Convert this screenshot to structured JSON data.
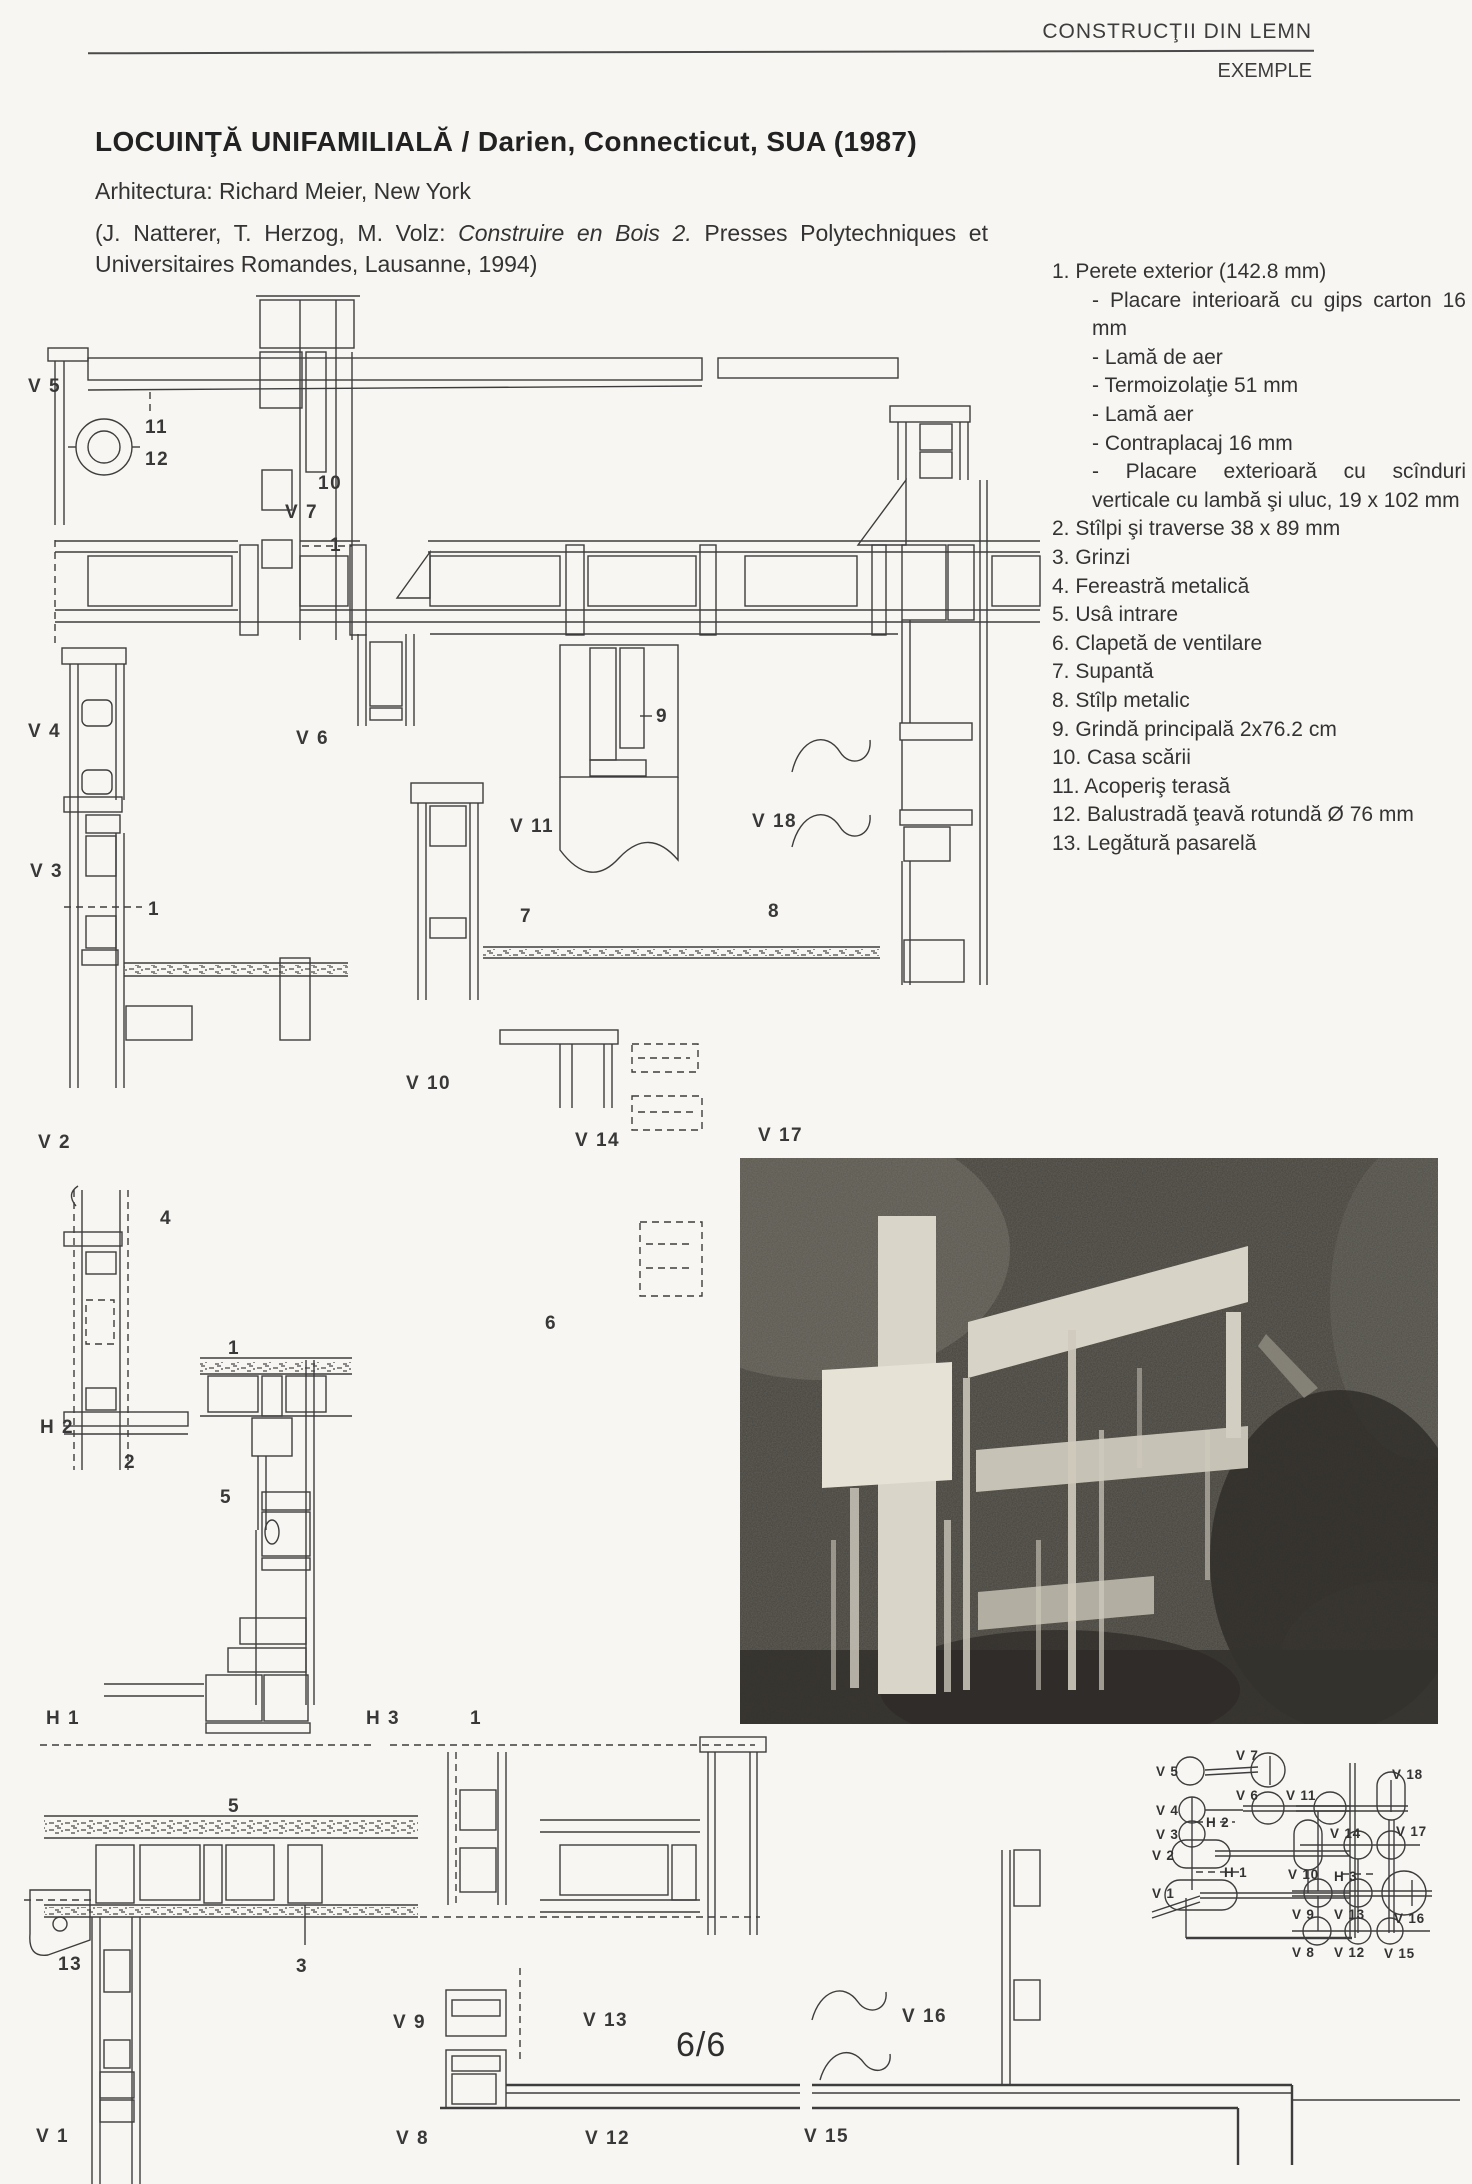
{
  "header": {
    "book_title": "CONSTRUCŢII DIN LEMN",
    "section": "EXEMPLE"
  },
  "title": "LOCUINŢĂ UNIFAMILIALĂ / Darien, Connecticut, SUA (1987)",
  "architect_line": "Arhitectura: Richard Meier, New York",
  "citation": {
    "part1": "(J. Natterer, T. Herzog, M. Volz: ",
    "italic": "Construire en Bois 2.",
    "part2": " Presses Polytechniques et Universitaires Romandes, Lausanne, 1994)"
  },
  "legend": {
    "items": [
      {
        "text": "1. Perete exterior (142.8 mm)",
        "indent": 0
      },
      {
        "text": "- Placare interioară cu gips carton 16 mm",
        "indent": 1
      },
      {
        "text": "- Lamă de aer",
        "indent": 1
      },
      {
        "text": "- Termoizolaţie 51 mm",
        "indent": 1
      },
      {
        "text": "- Lamă aer",
        "indent": 1
      },
      {
        "text": "- Contraplacaj 16 mm",
        "indent": 1
      },
      {
        "text": "- Placare exterioară cu scînduri verticale cu lambă şi uluc, 19 x 102 mm",
        "indent": 1
      },
      {
        "text": "2. Stîlpi şi traverse 38 x 89 mm",
        "indent": 0
      },
      {
        "text": "3. Grinzi",
        "indent": 0
      },
      {
        "text": "4. Fereastră metalică",
        "indent": 0
      },
      {
        "text": "5. Usâ intrare",
        "indent": 0
      },
      {
        "text": "6. Clapetă de ventilare",
        "indent": 0
      },
      {
        "text": "7. Supantă",
        "indent": 0
      },
      {
        "text": "8. Stîlp metalic",
        "indent": 0
      },
      {
        "text": "9. Grindă principală 2x76.2 cm",
        "indent": 0
      },
      {
        "text": "10. Casa scării",
        "indent": 0
      },
      {
        "text": "11. Acoperiş terasă",
        "indent": 0
      },
      {
        "text": "12. Balustradă ţeavă rotundă Ø 76 mm",
        "indent": 0
      },
      {
        "text": "13. Legătură pasarelă",
        "indent": 0
      }
    ]
  },
  "page_number": "6/6",
  "drawing": {
    "labels": [
      {
        "text": "V 5",
        "x": 28,
        "y": 392
      },
      {
        "text": "11",
        "x": 145,
        "y": 433
      },
      {
        "text": "12",
        "x": 145,
        "y": 465
      },
      {
        "text": "10",
        "x": 318,
        "y": 489
      },
      {
        "text": "V 7",
        "x": 285,
        "y": 518
      },
      {
        "text": "1",
        "x": 330,
        "y": 551
      },
      {
        "text": "V 4",
        "x": 28,
        "y": 737
      },
      {
        "text": "V 6",
        "x": 296,
        "y": 744
      },
      {
        "text": "9",
        "x": 656,
        "y": 722
      },
      {
        "text": "V 3",
        "x": 30,
        "y": 877
      },
      {
        "text": "1",
        "x": 148,
        "y": 915
      },
      {
        "text": "V 11",
        "x": 510,
        "y": 832
      },
      {
        "text": "V 18",
        "x": 752,
        "y": 827
      },
      {
        "text": "7",
        "x": 520,
        "y": 922
      },
      {
        "text": "8",
        "x": 768,
        "y": 917
      },
      {
        "text": "V 10",
        "x": 406,
        "y": 1089
      },
      {
        "text": "V 2",
        "x": 38,
        "y": 1148
      },
      {
        "text": "V 14",
        "x": 575,
        "y": 1146
      },
      {
        "text": "V 17",
        "x": 758,
        "y": 1141
      },
      {
        "text": "4",
        "x": 160,
        "y": 1224
      },
      {
        "text": "6",
        "x": 545,
        "y": 1329
      },
      {
        "text": "1",
        "x": 228,
        "y": 1354
      },
      {
        "text": "H 2",
        "x": 40,
        "y": 1433
      },
      {
        "text": "2",
        "x": 124,
        "y": 1468
      },
      {
        "text": "5",
        "x": 220,
        "y": 1503
      },
      {
        "text": "H 1",
        "x": 46,
        "y": 1724
      },
      {
        "text": "H 3",
        "x": 366,
        "y": 1724
      },
      {
        "text": "1",
        "x": 470,
        "y": 1724
      },
      {
        "text": "5",
        "x": 228,
        "y": 1812
      },
      {
        "text": "13",
        "x": 58,
        "y": 1970
      },
      {
        "text": "3",
        "x": 296,
        "y": 1972
      },
      {
        "text": "V 9",
        "x": 393,
        "y": 2028
      },
      {
        "text": "V 13",
        "x": 583,
        "y": 2026
      },
      {
        "text": "V 16",
        "x": 902,
        "y": 2022
      },
      {
        "text": "V 1",
        "x": 36,
        "y": 2142
      },
      {
        "text": "V 8",
        "x": 396,
        "y": 2144
      },
      {
        "text": "V 12",
        "x": 585,
        "y": 2144
      },
      {
        "text": "V 15",
        "x": 804,
        "y": 2142
      }
    ]
  },
  "key_diagram": {
    "labels": [
      {
        "text": "V 5",
        "x": 1156,
        "y": 1776
      },
      {
        "text": "V 7",
        "x": 1236,
        "y": 1760
      },
      {
        "text": "V 6",
        "x": 1236,
        "y": 1800
      },
      {
        "text": "V 4",
        "x": 1156,
        "y": 1815
      },
      {
        "text": "H 2",
        "x": 1206,
        "y": 1827
      },
      {
        "text": "V 3",
        "x": 1156,
        "y": 1839
      },
      {
        "text": "V 2",
        "x": 1152,
        "y": 1860
      },
      {
        "text": "H 1",
        "x": 1224,
        "y": 1877
      },
      {
        "text": "V 1",
        "x": 1152,
        "y": 1898
      },
      {
        "text": "V 11",
        "x": 1286,
        "y": 1800
      },
      {
        "text": "V 18",
        "x": 1392,
        "y": 1779
      },
      {
        "text": "V 14",
        "x": 1330,
        "y": 1838
      },
      {
        "text": "V 17",
        "x": 1396,
        "y": 1836
      },
      {
        "text": "V 10",
        "x": 1288,
        "y": 1879
      },
      {
        "text": "H 3",
        "x": 1334,
        "y": 1881
      },
      {
        "text": "V 16",
        "x": 1394,
        "y": 1923
      },
      {
        "text": "V 9",
        "x": 1292,
        "y": 1919
      },
      {
        "text": "V 13",
        "x": 1334,
        "y": 1919
      },
      {
        "text": "V 8",
        "x": 1292,
        "y": 1957
      },
      {
        "text": "V 12",
        "x": 1334,
        "y": 1957
      },
      {
        "text": "V 15",
        "x": 1384,
        "y": 1958
      }
    ]
  }
}
